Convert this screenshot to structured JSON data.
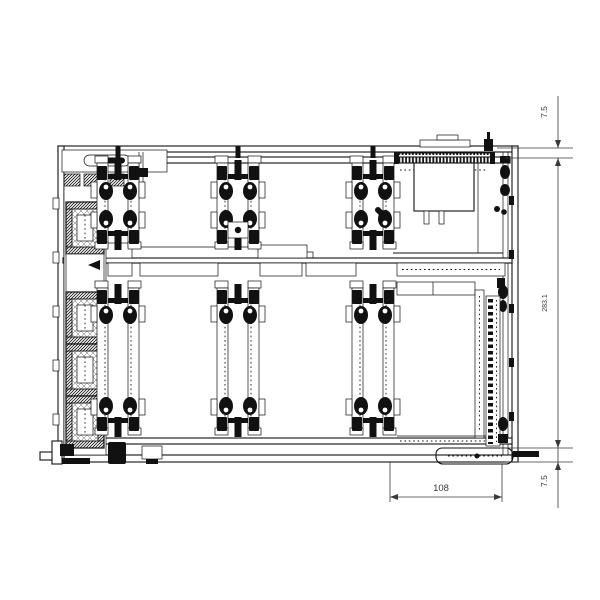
{
  "colors": {
    "background": "#ffffff",
    "line": "#111111",
    "dim": "#3a3a3a"
  },
  "dimensions": {
    "top_right": "7.5",
    "right_overall": "283.1",
    "bottom_right": "7.5",
    "bottom_width": "108"
  }
}
